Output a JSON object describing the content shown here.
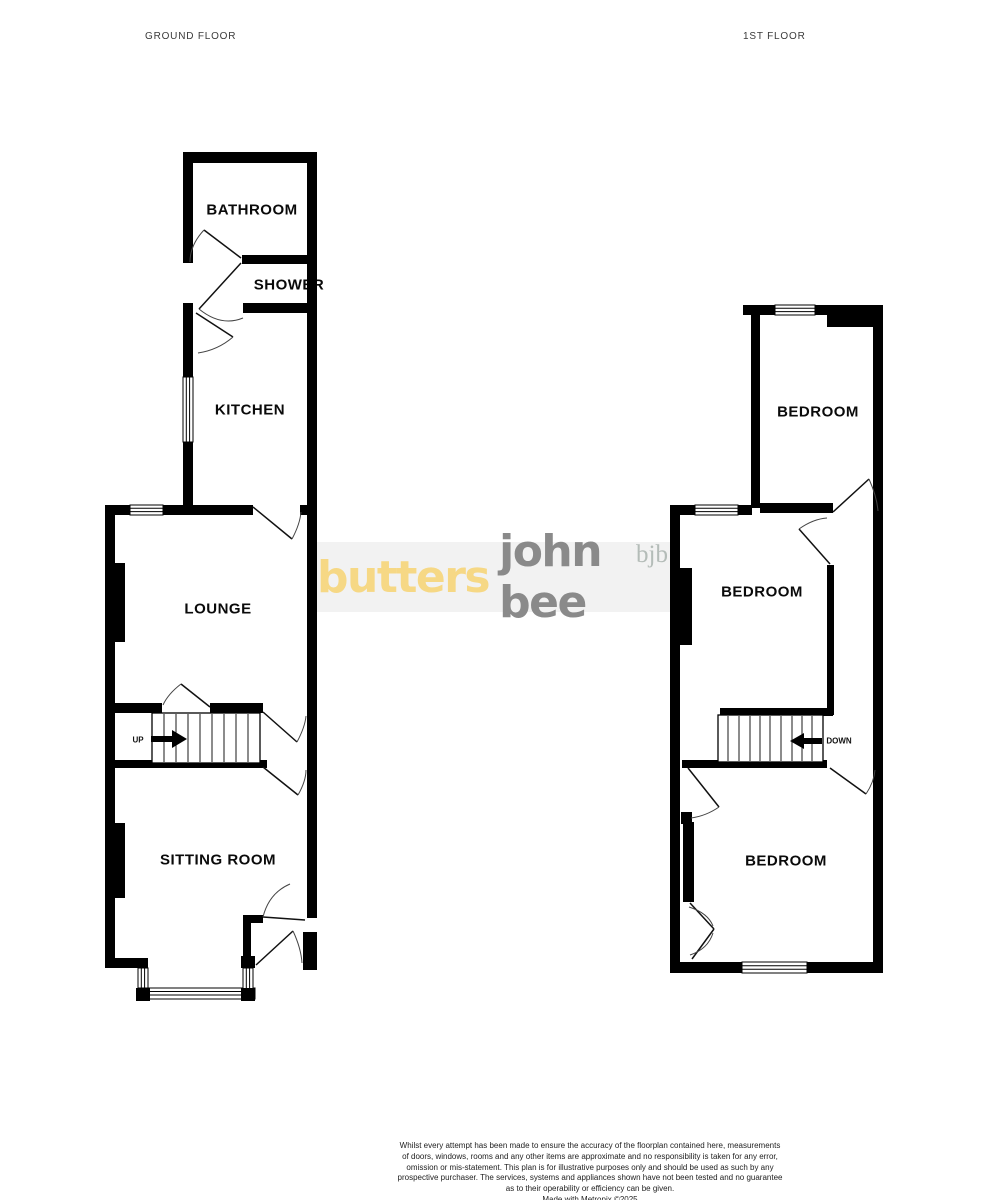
{
  "titles": {
    "ground": "GROUND FLOOR",
    "first": "1ST FLOOR"
  },
  "rooms": {
    "bathroom": "BATHROOM",
    "shower": "SHOWER",
    "kitchen": "KITCHEN",
    "lounge": "LOUNGE",
    "sitting_room": "SITTING ROOM",
    "bedroom_rear": "BEDROOM",
    "bedroom_middle": "BEDROOM",
    "bedroom_front": "BEDROOM"
  },
  "stairs": {
    "up": "UP",
    "down": "DOWN"
  },
  "logo": {
    "butters": "butters",
    "john_bee": "john bee",
    "bjb": "bjb",
    "butters_color": "#F6D885",
    "john_bee_color": "#8A8A8A",
    "bjb_color": "#B4BCB8",
    "band_color": "#F2F2F2"
  },
  "colors": {
    "wall": "#000000",
    "door_arc": "#444444",
    "background": "#FFFFFF"
  },
  "footer": {
    "disclaimer": "Whilst every attempt has been made to ensure the accuracy of the floorplan contained here, measurements\nof doors, windows, rooms and any other items are approximate and no responsibility is taken for any error,\nomission or mis-statement. This plan is for illustrative purposes only and should be used as such by any\nprospective purchaser. The services, systems and appliances shown have not been tested and no guarantee\nas to their operability or efficiency can be given.",
    "credit": "Made with Metropix ©2025"
  }
}
